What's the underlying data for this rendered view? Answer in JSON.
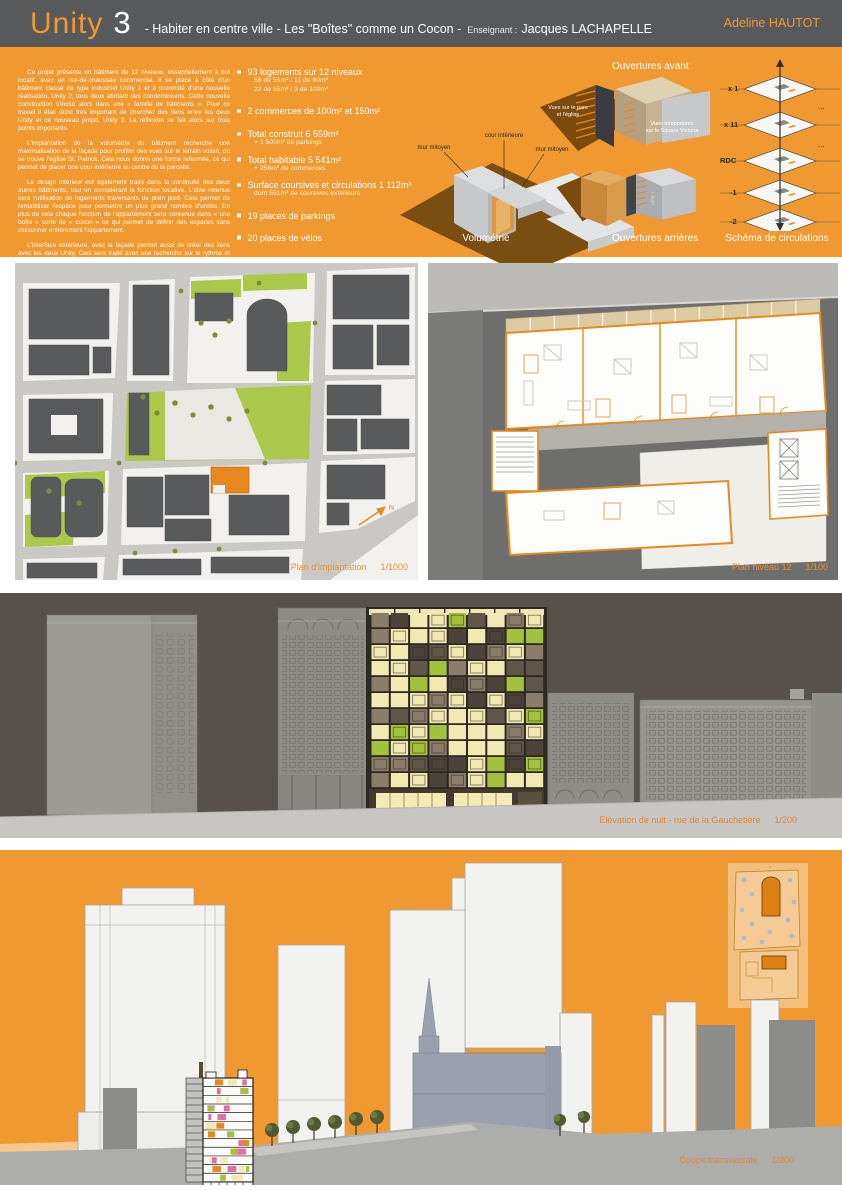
{
  "header": {
    "title_main": "Unity",
    "title_num": "3",
    "subtitle": "-  Habiter en centre ville - Les \"Boîtes\" comme un Cocon -",
    "teacher_label": "Enseignant :",
    "teacher_name": "Jacques LACHAPELLE",
    "author": "Adeline HAUTOT"
  },
  "intro": {
    "paragraphs": [
      "Ce projet présente un bâtiment de 12 niveaux, essentiellement à but locatif, avec un rez-de-chaussée commercial. Il se place à côté d'un bâtiment classé de type industriel Unity 1 et à proximité d'une nouvelle réalisation, Unity 2, tous deux abritant des condominiums. Cette nouvelle construction s'inclut alors dans une « famille de bâtiments ». Pour ce travail il était donc très important de chercher des liens entre les deux Unity et ce nouveau projet, Unity 3. La réflexion se fait alors sur trois points importants.",
      "L'implantation de la volumétrie du bâtiment recherche une maximalisation de la façade pour profiter des vues sur le terrain voisin, où se trouve l'église St. Patrick. Cela nous donne une forme refermée, ce qui permet de placer une cour intérieure au centre de la parcelle.",
      "Le design intérieur est également traité dans la continuité des deux autres bâtiments, tout en considérant la fonction locative. L'idée retenue sera l'utilisation de logements traversants de plein pied. Cela permet de rentabiliser l'espace pour permettre un plus grand nombre d'unités. En plus de cela chaque fonction de l'appartement sera contenue dans « une boîte » sorte de « cocon » ce qui permet de définir des espaces sans cloisonner entièrement l'appartement.",
      "L'interface extérieure, avec la façade permet aussi de créer des liens avec les deux Unity. Ceci sera traité avec une recherche sur le rythme et l'épaisseur. Des émergences de « boîtes » viennent ponctuer la façade, ainsi que des panneaux de couleur verte, ce qui donne différentes couches. A cela est ajouté la notion de rythme aléatoire pour le placement des fenêtres dans le but de permettre une façade dynamique à l'image de la variété des logements."
    ]
  },
  "stats": {
    "items": [
      {
        "label": "93 logements sur 12 niveaux",
        "subs": [
          "56 de 55m² / 11 de 60m²",
          "22 de 65m² / 3 de 100m²"
        ]
      },
      {
        "label": "2 commerces de 100m² et 150m²",
        "subs": []
      },
      {
        "label": "Total construit 6 559m²",
        "subs": [
          "+ 1 500m² de parkings"
        ]
      },
      {
        "label": "Total habitable 5 541m²",
        "subs": [
          "+ 258m² de commerces"
        ]
      },
      {
        "label": "Surface coursives et circulations 1 112m²",
        "subs": [
          "dont 551m² de coursives exterieurs"
        ]
      },
      {
        "label": "19 places de parkings",
        "subs": []
      },
      {
        "label": "20 places de vélos",
        "subs": []
      }
    ]
  },
  "diagrams": {
    "volumetrie": {
      "caption": "Volumétrie",
      "label_mur_left": "mur mitoyen",
      "label_cour": "cour intérieure",
      "label_mur_right": "mur mitoyen"
    },
    "avant": {
      "caption": "Ouvertures avant",
      "label1_line1": "Vues sur le parc",
      "label1_line2": "et l'église",
      "label2_line1": "Vues temporaires",
      "label2_line2": "sur le Square Victoria"
    },
    "arrieres": {
      "caption": "Ouvertures arrières",
      "label_unity1": "Unity 1"
    },
    "circulations": {
      "caption": "Schéma de circulations",
      "levels": [
        "x 1",
        "x 11",
        "RDC",
        "-1",
        "-2"
      ],
      "dots": "..."
    }
  },
  "plans": {
    "implantation": {
      "caption": "Plan d'implantation",
      "scale": "1/1000",
      "north": "N"
    },
    "niveau12": {
      "caption": "Plan niveau 12",
      "scale": "1/100"
    }
  },
  "elevation": {
    "caption": "Elévation de nuit - rue de la Gauchetière",
    "scale": "1/200"
  },
  "coupe": {
    "caption": "Coupe transversale",
    "scale": "1/200"
  },
  "colors": {
    "accent": "#EF9930",
    "accent_deep": "#E8891E",
    "header_bg": "#58595B",
    "elevation_bg": "#57504B",
    "facade_palette": [
      "#F0E9B2",
      "#A4C13C",
      "#8A7E6B",
      "#615749",
      "#4C443A"
    ],
    "section_palette": [
      "#E8891E",
      "#A4C13C",
      "#E06FA8",
      "#F0E9B2"
    ],
    "green": "#ACC84B",
    "dark_building": "#595A5C"
  }
}
